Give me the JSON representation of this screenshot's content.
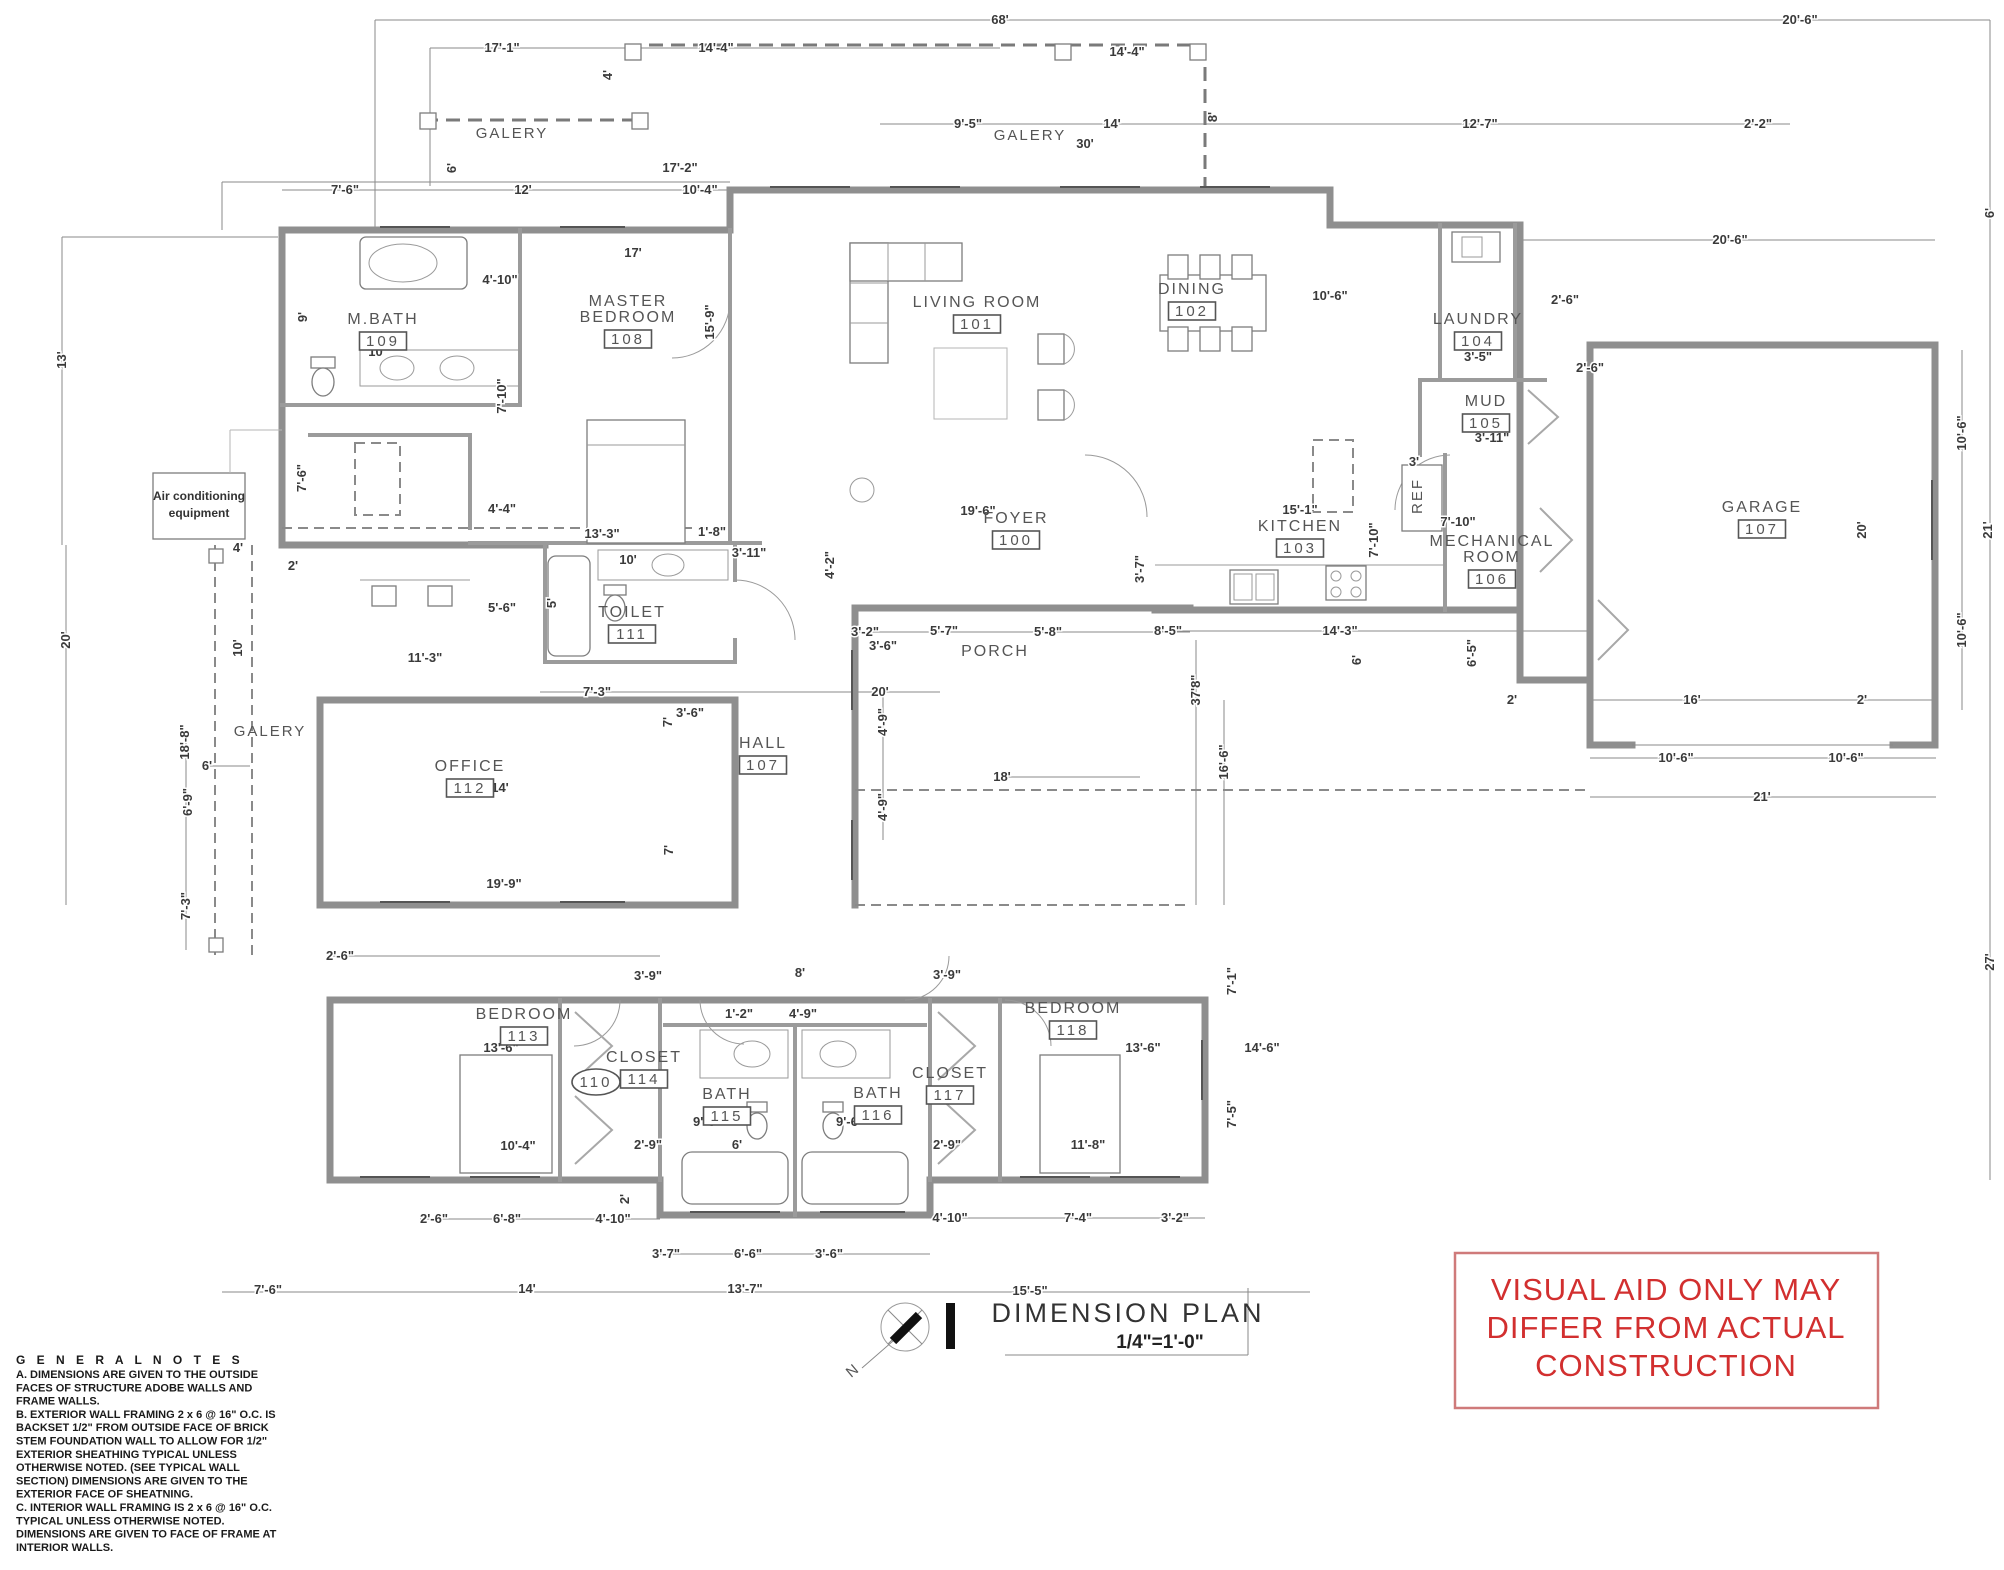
{
  "title_block": {
    "title": "DIMENSION  PLAN",
    "scale": "1/4\"=1'-0\"",
    "north_label": "N"
  },
  "warning": {
    "lines": [
      "VISUAL AID ONLY MAY",
      "DIFFER FROM ACTUAL",
      "CONSTRUCTION"
    ],
    "color": "#d22f2f"
  },
  "general_notes": {
    "heading": "G E N E R A L N O T E S",
    "lines": [
      "A.        DIMENSIONS ARE GIVEN TO THE OUTSIDE",
      "FACES OF STRUCTURE ADOBE WALLS AND",
      "FRAME WALLS.",
      "B.        EXTERIOR WALL FRAMING 2 x 6 @ 16\" O.C. IS",
      "BACKSET 1/2\" FROM OUTSIDE FACE OF BRICK",
      "STEM FOUNDATION WALL TO ALLOW FOR 1/2\"",
      "EXTERIOR SHEATHING TYPICAL UNLESS",
      "OTHERWISE NOTED. (SEE TYPICAL WALL",
      "SECTION) DIMENSIONS ARE GIVEN TO THE",
      "EXTERIOR FACE OF SHEATNING.",
      "C.        INTERIOR WALL FRAMING IS 2 x 6 @ 16\" O.C.",
      "TYPICAL UNLESS OTHERWISE NOTED.",
      "DIMENSIONS ARE GIVEN TO FACE OF FRAME AT",
      "INTERIOR WALLS."
    ]
  },
  "rooms": [
    {
      "name": "FOYER",
      "number": "100",
      "x": 1016,
      "y": 523
    },
    {
      "name": "LIVING ROOM",
      "number": "101",
      "x": 977,
      "y": 307
    },
    {
      "name": "DINING",
      "number": "102",
      "x": 1192,
      "y": 294
    },
    {
      "name": "KITCHEN",
      "number": "103",
      "x": 1300,
      "y": 531
    },
    {
      "name": "LAUNDRY",
      "number": "104",
      "x": 1478,
      "y": 324
    },
    {
      "name": "MUD",
      "number": "105",
      "x": 1486,
      "y": 406
    },
    {
      "name": "MECHANICAL\nROOM",
      "number": "106",
      "x": 1492,
      "y": 546
    },
    {
      "name": "GARAGE",
      "number": "107",
      "x": 1762,
      "y": 512
    },
    {
      "name": "HALL",
      "number": "107",
      "x": 763,
      "y": 748
    },
    {
      "name": "MASTER\nBEDROOM",
      "number": "108",
      "x": 628,
      "y": 306
    },
    {
      "name": "M.BATH",
      "number": "109",
      "x": 383,
      "y": 324
    },
    {
      "name": "TOILET",
      "number": "111",
      "x": 632,
      "y": 617
    },
    {
      "name": "OFFICE",
      "number": "112",
      "x": 470,
      "y": 771
    },
    {
      "name": "BEDROOM",
      "number": "113",
      "x": 524,
      "y": 1019
    },
    {
      "name": "CLOSET",
      "number": "114",
      "x": 644,
      "y": 1062
    },
    {
      "name": "BATH",
      "number": "115",
      "x": 727,
      "y": 1099
    },
    {
      "name": "BATH",
      "number": "116",
      "x": 878,
      "y": 1098
    },
    {
      "name": "CLOSET",
      "number": "117",
      "x": 950,
      "y": 1078
    },
    {
      "name": "BEDROOM",
      "number": "118",
      "x": 1073,
      "y": 1013
    },
    {
      "name": "PORCH",
      "number": "",
      "x": 995,
      "y": 656
    }
  ],
  "labels": [
    {
      "t": "GALERY",
      "x": 512,
      "y": 138,
      "r": 0
    },
    {
      "t": "GALERY",
      "x": 1030,
      "y": 140,
      "r": 0
    },
    {
      "t": "GALERY",
      "x": 270,
      "y": 736,
      "r": 0
    },
    {
      "t": "REF",
      "x": 1422,
      "y": 496,
      "r": -90
    },
    {
      "t": "N",
      "x": 856,
      "y": 1374,
      "r": -40
    }
  ],
  "oval_label": {
    "t": "110",
    "x": 596,
    "y": 1087
  },
  "ac_box": {
    "line1": "Air conditioning",
    "line2": "equipment",
    "x": 199,
    "y": 500
  },
  "dims": [
    {
      "t": "68'",
      "x": 1000,
      "y": 20,
      "r": 0
    },
    {
      "t": "20'-6\"",
      "x": 1800,
      "y": 20,
      "r": 0
    },
    {
      "t": "17'-1\"",
      "x": 502,
      "y": 48,
      "r": 0
    },
    {
      "t": "14'-4\"",
      "x": 716,
      "y": 48,
      "r": 0
    },
    {
      "t": "14'-4\"",
      "x": 1127,
      "y": 52,
      "r": 0
    },
    {
      "t": "4'",
      "x": 608,
      "y": 75,
      "r": -90
    },
    {
      "t": "8'",
      "x": 1213,
      "y": 117,
      "r": -90
    },
    {
      "t": "9'-5\"",
      "x": 968,
      "y": 124,
      "r": 0
    },
    {
      "t": "14'",
      "x": 1112,
      "y": 124,
      "r": 0
    },
    {
      "t": "30'",
      "x": 1085,
      "y": 144,
      "r": 0
    },
    {
      "t": "12'-7\"",
      "x": 1480,
      "y": 124,
      "r": 0
    },
    {
      "t": "2'-2\"",
      "x": 1758,
      "y": 124,
      "r": 0
    },
    {
      "t": "6'",
      "x": 452,
      "y": 168,
      "r": -90
    },
    {
      "t": "17'-2\"",
      "x": 680,
      "y": 168,
      "r": 0
    },
    {
      "t": "7'-6\"",
      "x": 345,
      "y": 190,
      "r": 0
    },
    {
      "t": "12'",
      "x": 523,
      "y": 190,
      "r": 0
    },
    {
      "t": "10'-4\"",
      "x": 700,
      "y": 190,
      "r": 0
    },
    {
      "t": "17'",
      "x": 633,
      "y": 253,
      "r": 0
    },
    {
      "t": "20'-6\"",
      "x": 1730,
      "y": 240,
      "r": 0
    },
    {
      "t": "6'",
      "x": 1990,
      "y": 213,
      "r": -90
    },
    {
      "t": "4'-10\"",
      "x": 500,
      "y": 280,
      "r": 0
    },
    {
      "t": "9'",
      "x": 303,
      "y": 317,
      "r": -90
    },
    {
      "t": "10'",
      "x": 377,
      "y": 352,
      "r": 0
    },
    {
      "t": "7'-10\"",
      "x": 502,
      "y": 396,
      "r": -90
    },
    {
      "t": "15'-9\"",
      "x": 710,
      "y": 322,
      "r": -90
    },
    {
      "t": "10'-6\"",
      "x": 1330,
      "y": 296,
      "r": 0
    },
    {
      "t": "3'-5\"",
      "x": 1478,
      "y": 357,
      "r": 0
    },
    {
      "t": "2'-6\"",
      "x": 1565,
      "y": 300,
      "r": 0
    },
    {
      "t": "13'",
      "x": 62,
      "y": 360,
      "r": -90
    },
    {
      "t": "3'-11\"",
      "x": 1492,
      "y": 438,
      "r": 0
    },
    {
      "t": "3'",
      "x": 1414,
      "y": 462,
      "r": 0
    },
    {
      "t": "10'-6\"",
      "x": 1962,
      "y": 433,
      "r": -90
    },
    {
      "t": "10'-6\"",
      "x": 1962,
      "y": 630,
      "r": -90
    },
    {
      "t": "21'",
      "x": 1988,
      "y": 530,
      "r": -90
    },
    {
      "t": "20'",
      "x": 1862,
      "y": 530,
      "r": -90
    },
    {
      "t": "2'-6\"",
      "x": 1590,
      "y": 368,
      "r": 0
    },
    {
      "t": "7'-6\"",
      "x": 302,
      "y": 478,
      "r": -90
    },
    {
      "t": "4'-4\"",
      "x": 502,
      "y": 509,
      "r": 0
    },
    {
      "t": "13'-3\"",
      "x": 602,
      "y": 534,
      "r": 0
    },
    {
      "t": "1'-8\"",
      "x": 712,
      "y": 532,
      "r": 0
    },
    {
      "t": "3'-11\"",
      "x": 749,
      "y": 553,
      "r": 0
    },
    {
      "t": "10'",
      "x": 628,
      "y": 560,
      "r": 0
    },
    {
      "t": "4'",
      "x": 238,
      "y": 548,
      "r": 0
    },
    {
      "t": "2'",
      "x": 293,
      "y": 566,
      "r": 0
    },
    {
      "t": "5'-6\"",
      "x": 502,
      "y": 608,
      "r": 0
    },
    {
      "t": "5'",
      "x": 552,
      "y": 603,
      "r": -90
    },
    {
      "t": "19'-6\"",
      "x": 978,
      "y": 511,
      "r": 0
    },
    {
      "t": "4'-2\"",
      "x": 830,
      "y": 565,
      "r": -90
    },
    {
      "t": "15'-1\"",
      "x": 1300,
      "y": 510,
      "r": 0
    },
    {
      "t": "7'-10\"",
      "x": 1374,
      "y": 540,
      "r": -90
    },
    {
      "t": "7'-10\"",
      "x": 1458,
      "y": 522,
      "r": 0
    },
    {
      "t": "3'-7\"",
      "x": 1140,
      "y": 569,
      "r": -90
    },
    {
      "t": "3'-2\"",
      "x": 865,
      "y": 632,
      "r": 0
    },
    {
      "t": "5'-7\"",
      "x": 944,
      "y": 631,
      "r": 0
    },
    {
      "t": "5'-8\"",
      "x": 1048,
      "y": 632,
      "r": 0
    },
    {
      "t": "8'-5\"",
      "x": 1168,
      "y": 631,
      "r": 0
    },
    {
      "t": "14'-3\"",
      "x": 1340,
      "y": 631,
      "r": 0
    },
    {
      "t": "6'",
      "x": 1357,
      "y": 660,
      "r": -90
    },
    {
      "t": "6'-5\"",
      "x": 1472,
      "y": 653,
      "r": -90
    },
    {
      "t": "3'-6\"",
      "x": 883,
      "y": 646,
      "r": 0
    },
    {
      "t": "4'-9\"",
      "x": 883,
      "y": 722,
      "r": -90
    },
    {
      "t": "18'",
      "x": 1002,
      "y": 777,
      "r": 0
    },
    {
      "t": "4'-9\"",
      "x": 883,
      "y": 807,
      "r": -90
    },
    {
      "t": "37'8\"",
      "x": 1196,
      "y": 690,
      "r": -90
    },
    {
      "t": "16'-6\"",
      "x": 1224,
      "y": 762,
      "r": -90
    },
    {
      "t": "2'",
      "x": 1512,
      "y": 700,
      "r": 0
    },
    {
      "t": "16'",
      "x": 1692,
      "y": 700,
      "r": 0
    },
    {
      "t": "2'",
      "x": 1862,
      "y": 700,
      "r": 0
    },
    {
      "t": "10'-6\"",
      "x": 1676,
      "y": 758,
      "r": 0
    },
    {
      "t": "10'-6\"",
      "x": 1846,
      "y": 758,
      "r": 0
    },
    {
      "t": "21'",
      "x": 1762,
      "y": 797,
      "r": 0
    },
    {
      "t": "27'",
      "x": 1990,
      "y": 962,
      "r": -90
    },
    {
      "t": "10'",
      "x": 238,
      "y": 648,
      "r": -90
    },
    {
      "t": "18'-8\"",
      "x": 185,
      "y": 742,
      "r": -90
    },
    {
      "t": "20'",
      "x": 66,
      "y": 640,
      "r": -90
    },
    {
      "t": "11'-3\"",
      "x": 425,
      "y": 658,
      "r": 0
    },
    {
      "t": "6'",
      "x": 207,
      "y": 766,
      "r": 0
    },
    {
      "t": "6'-9\"",
      "x": 188,
      "y": 802,
      "r": -90
    },
    {
      "t": "7'-3\"",
      "x": 186,
      "y": 906,
      "r": -90
    },
    {
      "t": "14'",
      "x": 500,
      "y": 788,
      "r": 0
    },
    {
      "t": "7'",
      "x": 668,
      "y": 722,
      "r": -90
    },
    {
      "t": "7'",
      "x": 669,
      "y": 850,
      "r": -90
    },
    {
      "t": "19'-9\"",
      "x": 504,
      "y": 884,
      "r": 0
    },
    {
      "t": "7'-3\"",
      "x": 597,
      "y": 692,
      "r": 0
    },
    {
      "t": "3'-6\"",
      "x": 690,
      "y": 713,
      "r": 0
    },
    {
      "t": "20'",
      "x": 880,
      "y": 692,
      "r": 0
    },
    {
      "t": "2'-6\"",
      "x": 340,
      "y": 956,
      "r": 0
    },
    {
      "t": "3'-9\"",
      "x": 648,
      "y": 976,
      "r": 0
    },
    {
      "t": "8'",
      "x": 800,
      "y": 973,
      "r": 0
    },
    {
      "t": "3'-9\"",
      "x": 947,
      "y": 975,
      "r": 0
    },
    {
      "t": "1'-2\"",
      "x": 739,
      "y": 1014,
      "r": 0
    },
    {
      "t": "4'-9\"",
      "x": 803,
      "y": 1014,
      "r": 0
    },
    {
      "t": "7'-1\"",
      "x": 1232,
      "y": 981,
      "r": -90
    },
    {
      "t": "13'-6\"",
      "x": 501,
      "y": 1048,
      "r": 0
    },
    {
      "t": "13'-6\"",
      "x": 1143,
      "y": 1048,
      "r": 0
    },
    {
      "t": "14'-6\"",
      "x": 1262,
      "y": 1048,
      "r": 0
    },
    {
      "t": "7'-5\"",
      "x": 1232,
      "y": 1114,
      "r": -90
    },
    {
      "t": "10'-4\"",
      "x": 518,
      "y": 1146,
      "r": 0
    },
    {
      "t": "2'-9\"",
      "x": 648,
      "y": 1145,
      "r": 0
    },
    {
      "t": "9'-6\"",
      "x": 707,
      "y": 1122,
      "r": 0
    },
    {
      "t": "6'",
      "x": 737,
      "y": 1145,
      "r": 0
    },
    {
      "t": "9'-6\"",
      "x": 850,
      "y": 1122,
      "r": 0
    },
    {
      "t": "2'-9\"",
      "x": 947,
      "y": 1145,
      "r": 0
    },
    {
      "t": "11'-8\"",
      "x": 1088,
      "y": 1145,
      "r": 0
    },
    {
      "t": "2'",
      "x": 625,
      "y": 1199,
      "r": -90
    },
    {
      "t": "2'-6\"",
      "x": 434,
      "y": 1219,
      "r": 0
    },
    {
      "t": "6'-8\"",
      "x": 507,
      "y": 1219,
      "r": 0
    },
    {
      "t": "4'-10\"",
      "x": 613,
      "y": 1219,
      "r": 0
    },
    {
      "t": "4'-10\"",
      "x": 950,
      "y": 1218,
      "r": 0
    },
    {
      "t": "7'-4\"",
      "x": 1078,
      "y": 1218,
      "r": 0
    },
    {
      "t": "3'-2\"",
      "x": 1175,
      "y": 1218,
      "r": 0
    },
    {
      "t": "3'-7\"",
      "x": 666,
      "y": 1254,
      "r": 0
    },
    {
      "t": "6'-6\"",
      "x": 748,
      "y": 1254,
      "r": 0
    },
    {
      "t": "3'-6\"",
      "x": 829,
      "y": 1254,
      "r": 0
    },
    {
      "t": "7'-6\"",
      "x": 268,
      "y": 1290,
      "r": 0
    },
    {
      "t": "14'",
      "x": 527,
      "y": 1289,
      "r": 0
    },
    {
      "t": "13'-7\"",
      "x": 745,
      "y": 1289,
      "r": 0
    },
    {
      "t": "15'-5\"",
      "x": 1030,
      "y": 1291,
      "r": 0
    }
  ]
}
